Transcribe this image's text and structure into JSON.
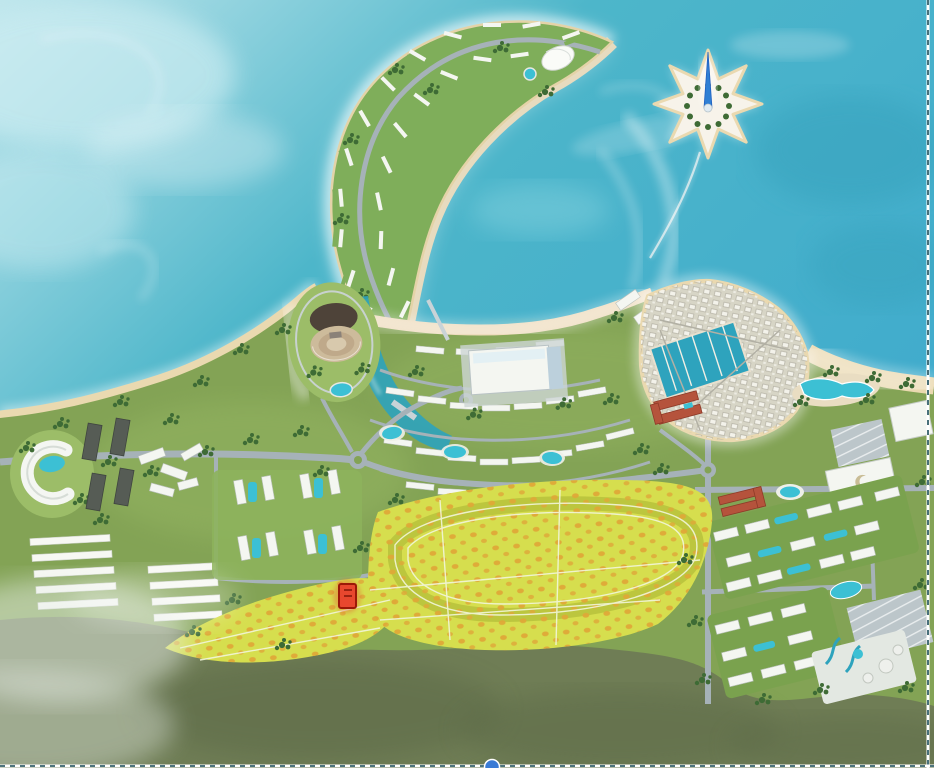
{
  "image": {
    "kind": "aerial-masterplan-render",
    "features": [
      "crescent-island",
      "star-island",
      "star-tower",
      "causeway",
      "lagoon",
      "amphitheater",
      "channel",
      "convention-center",
      "townhouse-district",
      "coastal-hotels-row",
      "old-town",
      "marina",
      "red-roof-hotel",
      "left-resort",
      "dark-roof-buildings",
      "greenhouse-strips",
      "apartment-compound",
      "orchard-field",
      "loop-track",
      "selected-plot-marker",
      "beach-club-pools",
      "mall",
      "parking-lot",
      "right-residential-grid",
      "water-park",
      "scrubland",
      "beach",
      "sea"
    ]
  },
  "colors": {
    "sea": "#4db6ca",
    "sea-deep": "#37a3bd",
    "sea-haze": "#cdedf2",
    "sand": "#ead9b0",
    "sand-pink": "#eedcbe",
    "surf": "#ffffff",
    "grass": "#83a355",
    "grass-light": "#9cbd68",
    "lawn": "#7aa24e",
    "scrub": "#6f7d55",
    "scrub-dark": "#5b6947",
    "fog": "#e8efe9",
    "cres-green": "#7fae5a",
    "tree": "#3e6b35",
    "road": "#a6b2b8",
    "road-light": "#c9d3d7",
    "bldg": "#f4f6f1",
    "bldg-edge": "#b9c0ba",
    "roof-dark": "#565c55",
    "roof-red": "#b5533c",
    "pool": "#3cc0d4",
    "pool-deep": "#2ea3bd",
    "town-base": "#d7d5c6",
    "orchard": "#d6de4e",
    "orchard-band": "#b7c23c",
    "orchard-dot": "#dfa838",
    "marker": "#e8472e",
    "marker-border": "#9c1808",
    "handle": "#3a7bd5",
    "marquee": "#35616b"
  },
  "marker": {
    "x": 339,
    "y": 584,
    "w": 17,
    "h": 24
  },
  "selection": {
    "handle_color": "#3a7bd5",
    "border_right_x": 928,
    "border_bottom_y": 766,
    "handle_cx": 492
  }
}
